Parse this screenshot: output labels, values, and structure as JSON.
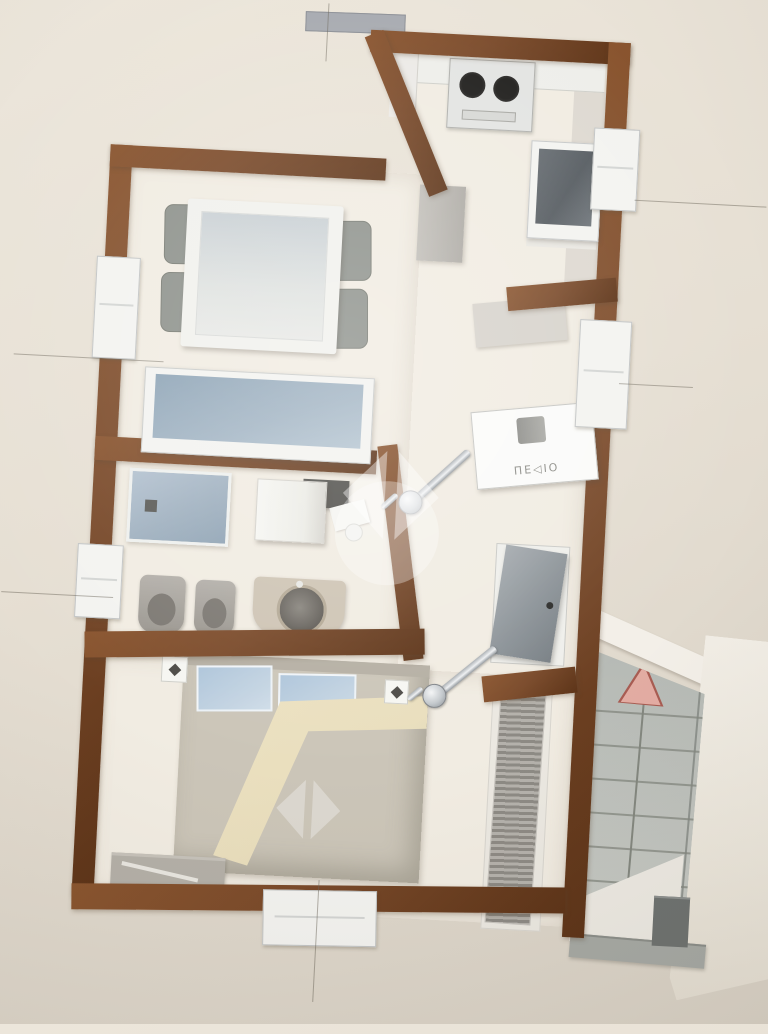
{
  "labels": {
    "utility_panel": "ΠΕ◁ΙΟ"
  },
  "icons": {
    "stairs_arrow": "up-triangle-direction-icon",
    "watermark": "diamond-and-circle-logo",
    "cooktop_burners": "two-dark-circles",
    "door_hardware": "chrome-swing-arm"
  },
  "colors": {
    "background": "#e4ddd1",
    "wall": "#7a4a2a",
    "wall_dark": "#5d3418",
    "wall_light": "#8a552f",
    "floor": "#f1ece2",
    "glass": "#9db0c0",
    "glass_light": "#c3d2de",
    "window_frame": "#f3f3f0",
    "stairs": "#b7bab5",
    "stair_line": "#83877f",
    "arrow_fill": "#e3aca3",
    "arrow_edge": "#a85c52",
    "chrome": "#c7cbcf",
    "blanket": "#e9debd",
    "pillow": "#b0c7dc",
    "bed_base": "#cbc5b8",
    "fixture_gray": "#9d9993",
    "white_wall": "#f3efe8"
  },
  "stairs": {
    "tread_rows": 6,
    "flights": 2
  },
  "counts": {
    "dining_chairs": 4,
    "bed_pillows": 2,
    "cooktop_burners": 2
  }
}
